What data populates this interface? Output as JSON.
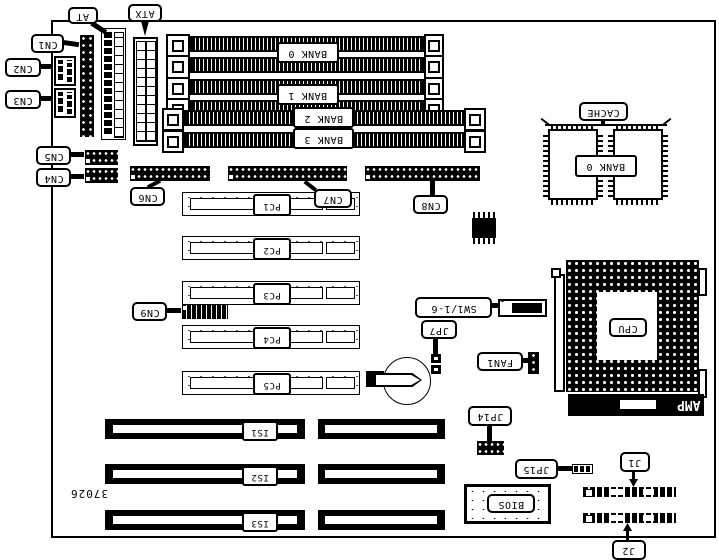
{
  "board": {
    "part_number": "37026",
    "surface_color": "#ffffff",
    "ink_color": "#000000"
  },
  "callouts": {
    "at": "AT",
    "atx": "ATX",
    "cn1": "CN1",
    "cn2": "CN2",
    "cn3": "CN3",
    "cn4": "CN4",
    "cn5": "CN5",
    "cn6": "CN6",
    "cn7": "CN7",
    "cn8": "CN8",
    "cn9": "CN9",
    "cache": "CACHE",
    "cpu": "CPU",
    "sw1": "SW1/1-6",
    "jp7": "JP7",
    "fan1": "FAN1",
    "jp14": "JP14",
    "jp15": "JP15",
    "j1": "J1",
    "j2": "J2",
    "bios": "BIOS"
  },
  "memory_banks": {
    "bank0": "BANK 0",
    "bank1": "BANK 1",
    "bank2": "BANK 2",
    "bank3": "BANK 3",
    "cache_bank0": "BANK 0"
  },
  "slots": {
    "pci": [
      "PC1",
      "PC2",
      "PC3",
      "PC4",
      "PC5"
    ],
    "isa": [
      "IS1",
      "IS2",
      "IS3"
    ]
  },
  "cpu_socket": {
    "brand": "AMP"
  }
}
